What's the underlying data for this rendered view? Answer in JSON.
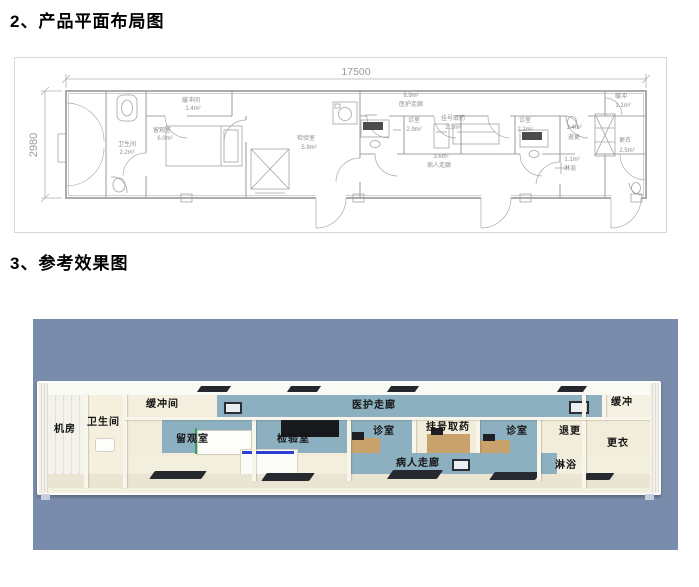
{
  "sections": {
    "plan_heading": "2、产品平面布局图",
    "render_heading": "3、参考效果图"
  },
  "floor_plan": {
    "dim_width": "17500",
    "dim_height": "2980",
    "rooms": [
      {
        "name": "卫生间",
        "area": "2.2m²"
      },
      {
        "name": "缓冲间",
        "area": "1.4m²"
      },
      {
        "name": "留观室",
        "area": "6.0m²"
      },
      {
        "name": "检验室",
        "area": "5.9m²"
      },
      {
        "name": "医护走廊",
        "area": "8.9m²"
      },
      {
        "name": "诊室",
        "area": "2.9m²"
      },
      {
        "name": "挂号取药",
        "area": "2.3m²"
      },
      {
        "name": "病人走廊",
        "area": "3.6m²"
      },
      {
        "name": "诊室",
        "area": "2.2m²"
      },
      {
        "name": "退更",
        "area": "1.4m²"
      },
      {
        "name": "缓冲",
        "area": "1.1m²"
      },
      {
        "name": "更衣",
        "area": "2.5m²"
      },
      {
        "name": "淋浴",
        "area": "1.1m²"
      }
    ]
  },
  "render": {
    "bg_color": "#7a8cab",
    "wall_blue": "#8cb0bf",
    "labels": {
      "jifang": "机房",
      "weishengjian": "卫生间",
      "huanchongjian": "缓冲间",
      "liuguanshi": "留观室",
      "jianyanshi": "检验室",
      "yihu_zoulang": "医护走廊",
      "zhenshi1": "诊室",
      "guahao_quyao": "挂号取药",
      "zhenshi2": "诊室",
      "bingren_zoulang": "病人走廊",
      "tuigeng": "退更",
      "linyu": "淋浴",
      "huanchong": "缓冲",
      "gengyi": "更衣"
    }
  }
}
